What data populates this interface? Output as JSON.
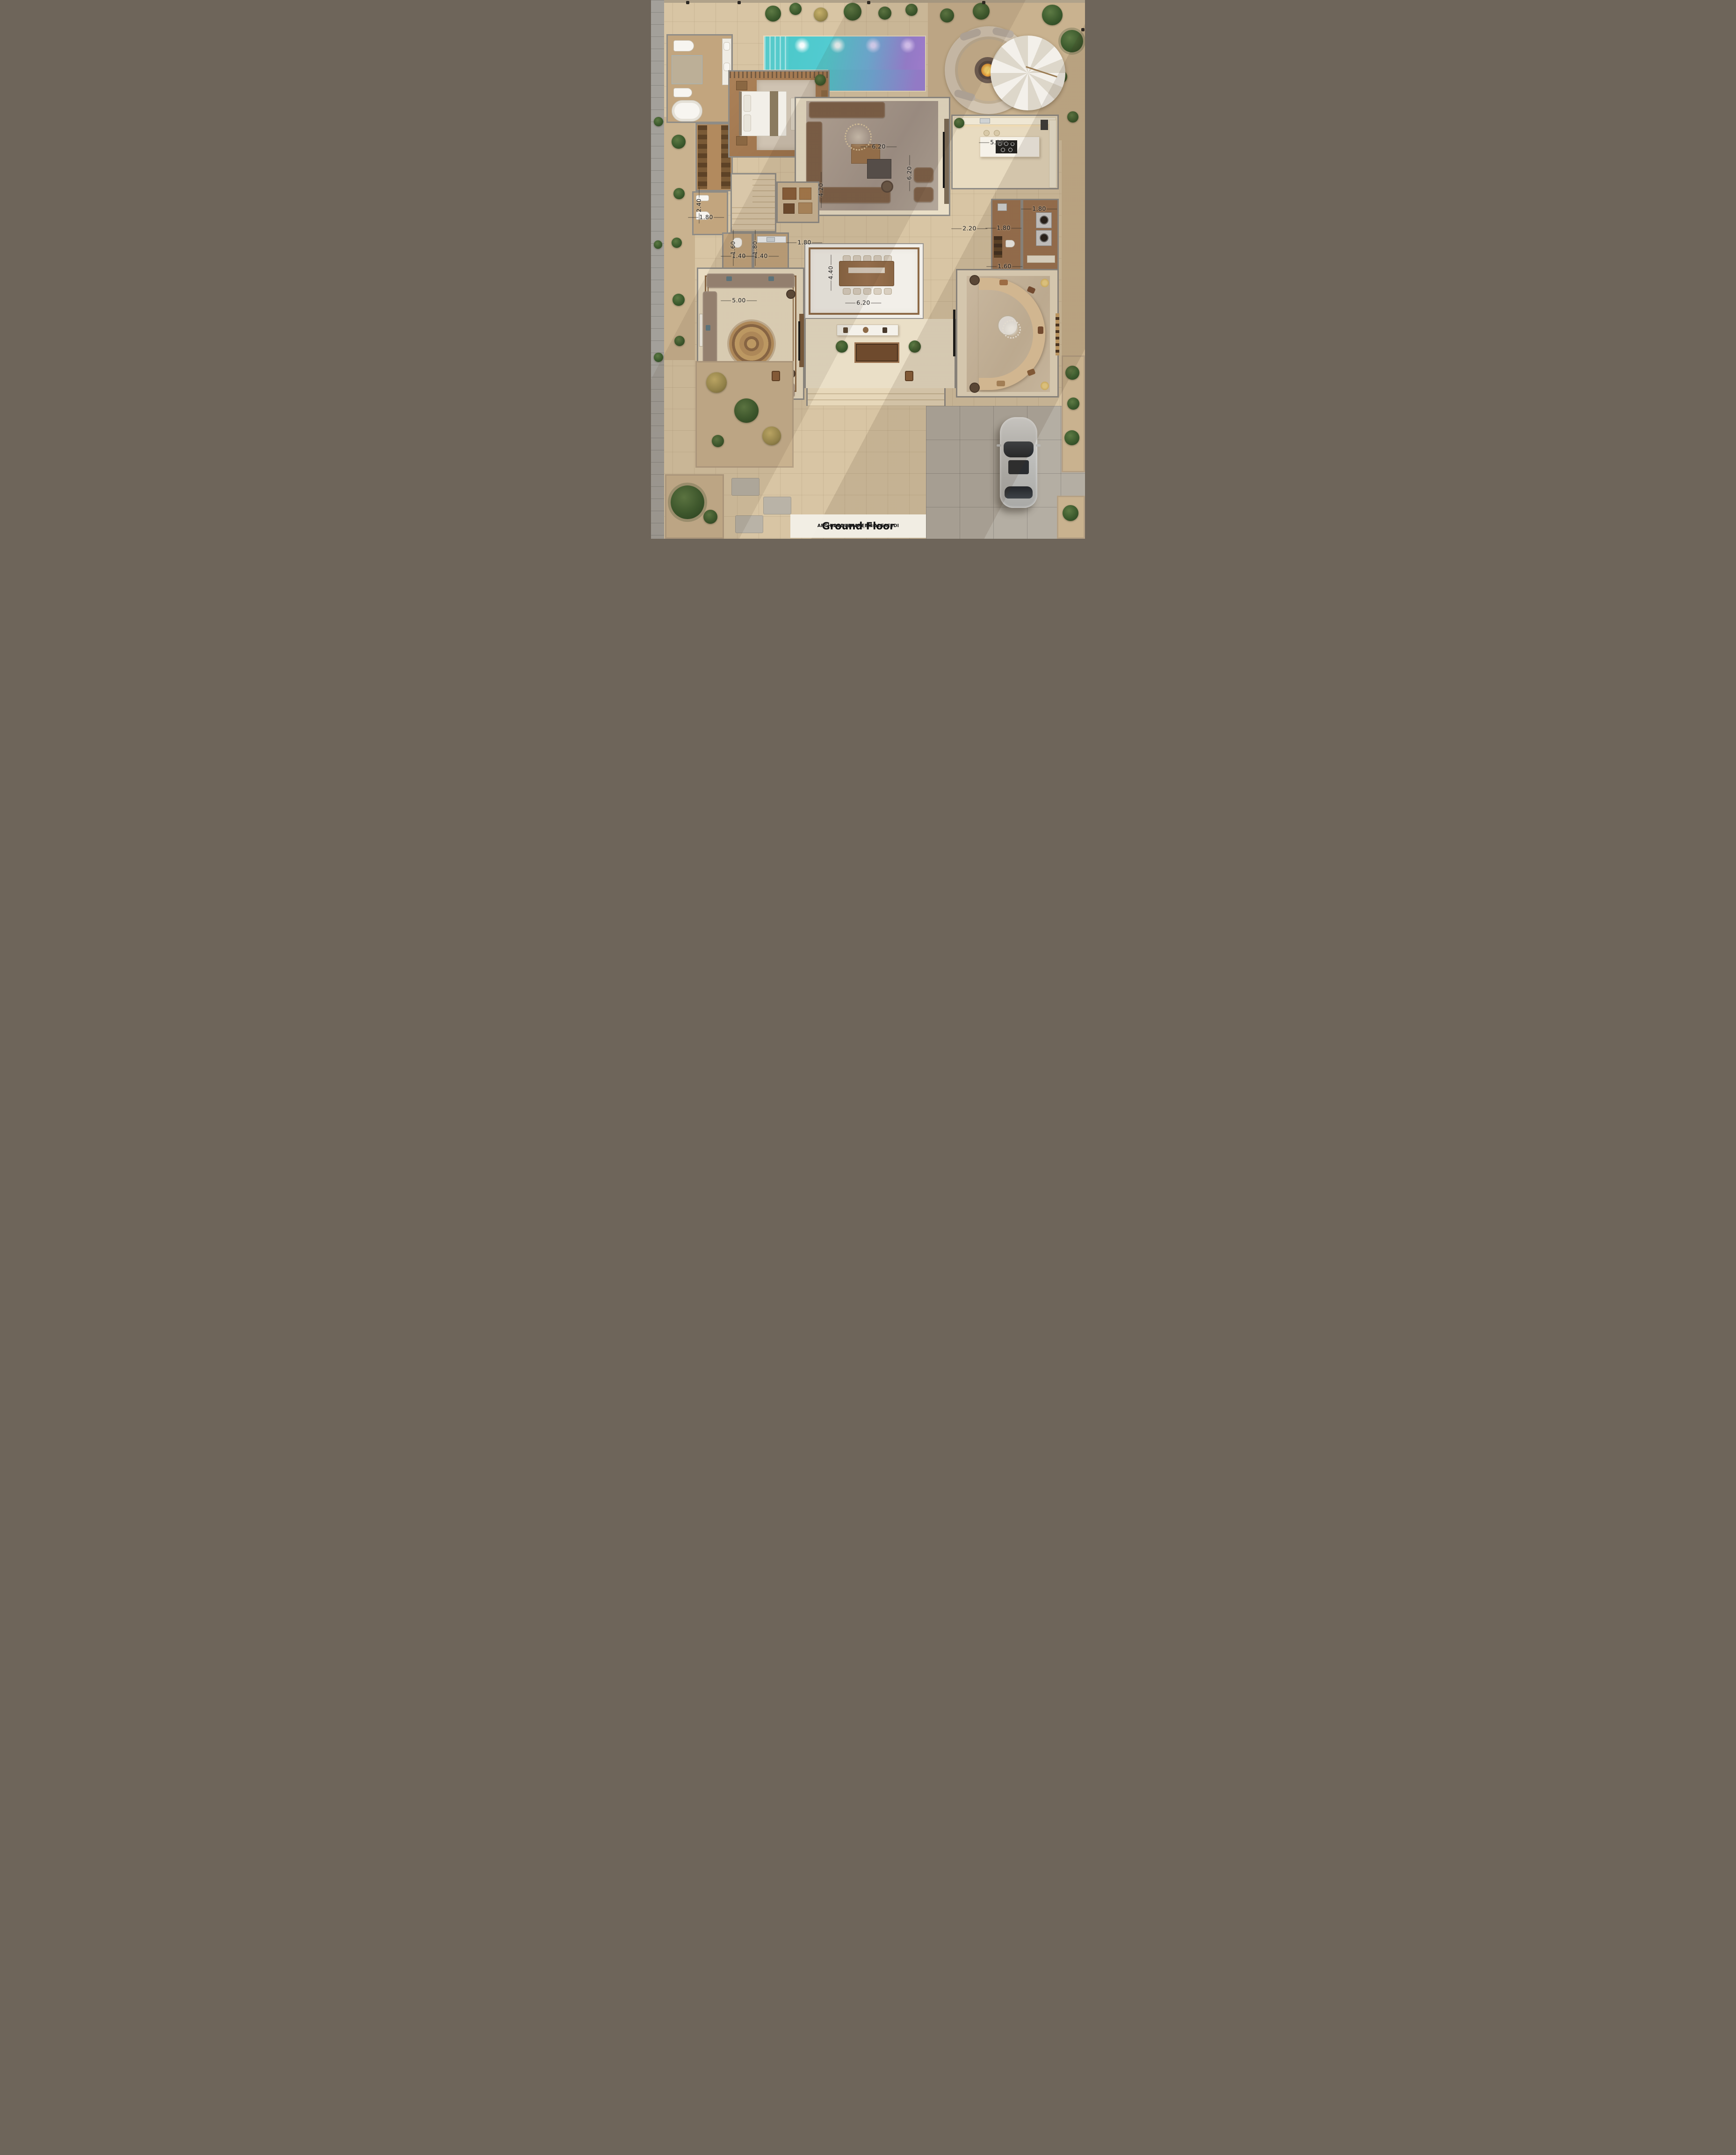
{
  "title_block": {
    "title": "Ground Floor",
    "architect": "ARCH-ABDULKAREEM ALSAEEDI",
    "social_handle": "twitter@arch_alsaeedi"
  },
  "dimension_labels": [
    {
      "value": "6.20",
      "orientation": "horizontal",
      "area": "living-room-width"
    },
    {
      "value": "6.20",
      "orientation": "vertical",
      "area": "living-room-depth"
    },
    {
      "value": "4.20",
      "orientation": "vertical",
      "area": "living-room-left-depth"
    },
    {
      "value": "5.00",
      "orientation": "horizontal",
      "area": "kitchen-width"
    },
    {
      "value": "2.40",
      "orientation": "vertical",
      "area": "guest-wc-depth"
    },
    {
      "value": "1.80",
      "orientation": "horizontal",
      "area": "guest-wc-width"
    },
    {
      "value": "1.60",
      "orientation": "vertical",
      "area": "powder-room-1-depth"
    },
    {
      "value": "1.40",
      "orientation": "horizontal",
      "area": "powder-room-1-width"
    },
    {
      "value": "1.80",
      "orientation": "vertical",
      "area": "powder-room-2-depth"
    },
    {
      "value": "1.40",
      "orientation": "horizontal",
      "area": "powder-room-2-width"
    },
    {
      "value": "1.80",
      "orientation": "horizontal",
      "area": "corridor-width"
    },
    {
      "value": "2.20",
      "orientation": "horizontal",
      "area": "hall-width"
    },
    {
      "value": "1.80",
      "orientation": "horizontal",
      "area": "maid-room-width"
    },
    {
      "value": "1.80",
      "orientation": "horizontal",
      "area": "laundry-width"
    },
    {
      "value": "1.60",
      "orientation": "horizontal",
      "area": "maid-wc-width"
    },
    {
      "value": "4.40",
      "orientation": "vertical",
      "area": "dining-depth"
    },
    {
      "value": "6.20",
      "orientation": "horizontal",
      "area": "dining-width"
    },
    {
      "value": "5.00",
      "orientation": "horizontal",
      "area": "majlis-width"
    }
  ],
  "colors": {
    "deck_tile": "#d8c5a4",
    "sand": "#c9b28f",
    "wall_gray": "#8f8c86",
    "interior_marble": "#ead_fc",
    "pool_water_teal": "#49c7c6",
    "pool_water_purple": "#9b82d8",
    "wood_floor": "#a97f56",
    "dining_marble": "#f2efe9",
    "dining_border": "#8d6a47",
    "sofa_brown": "#7d6048",
    "sofa_cream": "#e6c9a1",
    "majlis_sofa": "#9c8877",
    "title_text": "#101010"
  }
}
